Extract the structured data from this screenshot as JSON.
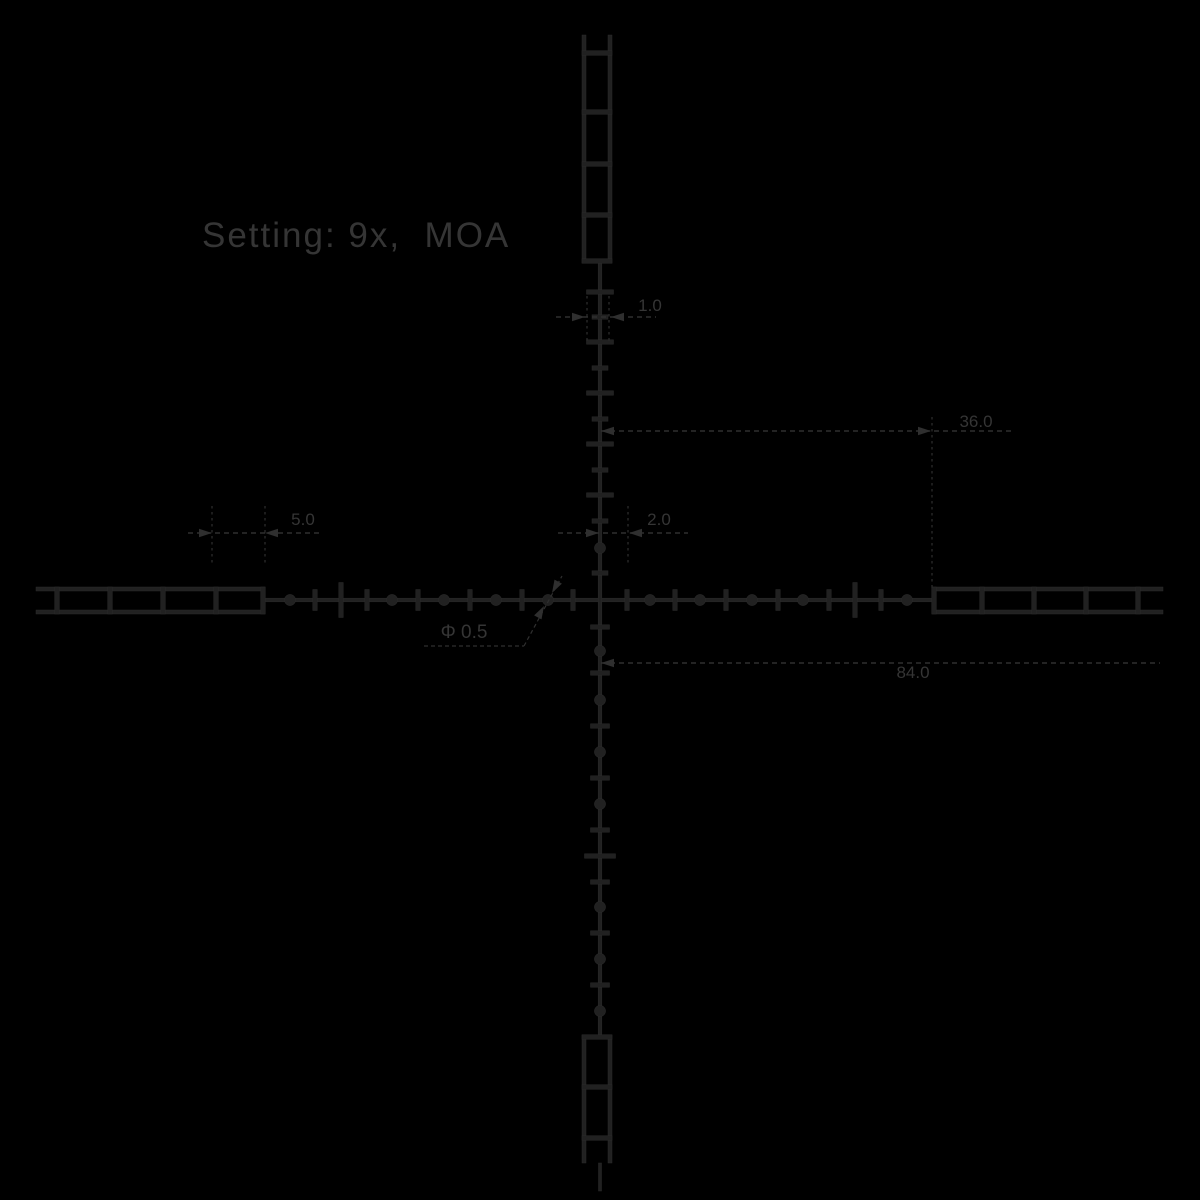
{
  "title": {
    "text": "Setting: 9x,  MOA"
  },
  "colors": {
    "background": "#000000",
    "ink": "#212121",
    "ink_edge": "#2b2b2b",
    "annotation": "#2f2f2f",
    "text": "#353535"
  },
  "dimensions": {
    "one": {
      "label": "1.0"
    },
    "two": {
      "label": "2.0"
    },
    "five": {
      "label": "5.0"
    },
    "thirtysix": {
      "label": "36.0"
    },
    "eightyfour": {
      "label": "84.0"
    },
    "phi": {
      "label": "Φ 0.5"
    }
  },
  "diagram": {
    "center": {
      "x": 600,
      "y": 600
    },
    "cross": {
      "h_from": 265,
      "h_to": 932,
      "h_y": 600,
      "v_from": 263,
      "v_to": 1035,
      "v_x": 600,
      "thickness": 3.6,
      "bottom_stub_from": 1163,
      "bottom_stub_to": 1191
    },
    "ladders": {
      "rail_w": 4,
      "rung_t": 4.6,
      "top": {
        "x1": 584,
        "x2": 610,
        "from": 35,
        "to": 263,
        "rungs": [
          53,
          112,
          164,
          215,
          261
        ]
      },
      "bottom": {
        "x1": 584,
        "x2": 610,
        "from": 1035,
        "to": 1163,
        "rungs": [
          1037,
          1087,
          1138
        ]
      },
      "left": {
        "y1": 589,
        "y2": 612,
        "from": 36,
        "to": 265,
        "rungs": [
          57,
          110,
          163,
          216,
          263
        ]
      },
      "right": {
        "y1": 589,
        "y2": 612,
        "from": 932,
        "to": 1163,
        "rungs": [
          934,
          982,
          1034,
          1086,
          1138
        ]
      }
    },
    "horizontal": {
      "tick_h": 21,
      "tall_h": 35,
      "bar_w": 4.4,
      "dot_r": 5.6,
      "ticks": [
        315,
        367,
        418,
        470,
        522,
        573,
        627,
        675,
        726,
        778,
        829,
        881
      ],
      "tall": [
        341,
        855
      ],
      "dots": [
        290,
        392,
        444,
        496,
        548,
        650,
        700,
        752,
        803,
        907
      ]
    },
    "vertical": {
      "bar_h": 4.4,
      "dot_r": 5.6,
      "wide_w": 27,
      "narrow_w": 16,
      "below_w": 19,
      "wide_below_w": 31,
      "wide_above": [
        292,
        342,
        393,
        444,
        495
      ],
      "narrow_above": [
        317,
        368,
        419,
        470,
        521,
        573
      ],
      "dots_above": [
        548
      ],
      "ticks_below": [
        627,
        673,
        726,
        778,
        830,
        882,
        933,
        985
      ],
      "wide_below": [
        856
      ],
      "dots_below": [
        651,
        700,
        752,
        804,
        907,
        959,
        1011
      ]
    },
    "annotations": {
      "one": {
        "line": [
          556,
          317,
          656,
          317
        ],
        "exts": [
          [
            587,
            296,
            587,
            342
          ],
          [
            609,
            296,
            609,
            342
          ]
        ],
        "arrows": [
          [
            585,
            317,
            0
          ],
          [
            611,
            317,
            180
          ]
        ]
      },
      "two": {
        "line": [
          558,
          533,
          688,
          533
        ],
        "exts": [
          [
            628,
            506,
            628,
            564
          ]
        ],
        "arrows": [
          [
            599,
            533,
            0
          ],
          [
            629,
            533,
            180
          ]
        ]
      },
      "five": {
        "line": [
          188,
          533,
          322,
          533
        ],
        "exts": [
          [
            212,
            506,
            212,
            566
          ],
          [
            265,
            506,
            265,
            566
          ]
        ],
        "arrows": [
          [
            212,
            533,
            0
          ],
          [
            265,
            533,
            180
          ]
        ]
      },
      "thirtysix": {
        "line": [
          601,
          431,
          1012,
          431
        ],
        "exts": [
          [
            932,
            417,
            932,
            589
          ]
        ],
        "arrows": [
          [
            601,
            431,
            180
          ],
          [
            931,
            431,
            0
          ]
        ]
      },
      "eightyfour": {
        "line": [
          601,
          663,
          1160,
          663
        ],
        "exts": [],
        "arrows": [
          [
            601,
            663,
            180
          ]
        ]
      },
      "phi": {
        "line": [
          424,
          646,
          524,
          646
        ],
        "leader": [
          524,
          646,
          562,
          576
        ],
        "arrows": [
          [
            544,
            606,
            -61.5
          ],
          [
            552,
            593,
            118.5
          ]
        ]
      }
    }
  }
}
